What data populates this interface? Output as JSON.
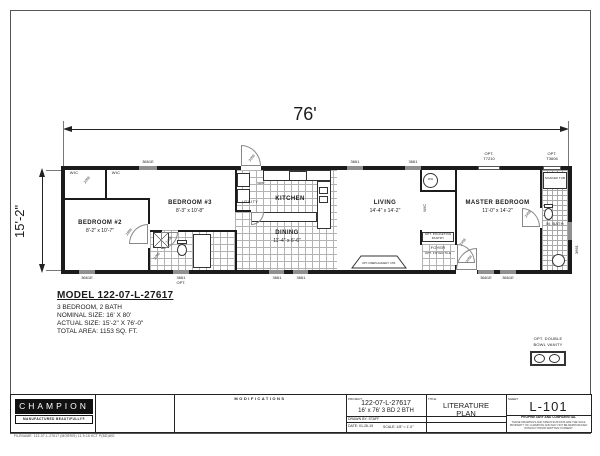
{
  "plan": {
    "dim_width": "76'",
    "dim_height": "15'-2\"",
    "bedroom2": {
      "name": "BEDROOM #2",
      "size": "8'-2\" x 10'-7\""
    },
    "bedroom3": {
      "name": "BEDROOM #3",
      "size": "8'-3\" x 10'-8\""
    },
    "kitchen": {
      "name": "KITCHEN"
    },
    "dining": {
      "name": "DINING",
      "size": "11'-4\" x 6'-6\""
    },
    "living": {
      "name": "LIVING",
      "size": "14'-4\" x 14'-2\""
    },
    "master": {
      "name": "MASTER BEDROOM",
      "size": "11'-0\" x 14'-2\""
    },
    "mbath": "M. BATH",
    "utility": "UTILITY",
    "foyer": "FOYER",
    "labels": {
      "wic": "WIC",
      "wh": "WH",
      "wdp": "WDP",
      "opt_foyer_tile": "OPT. FOYER TILE",
      "pantry_1": "OPT. POCKETING",
      "pantry_2": "PANTRY",
      "soaker_tub": "SOAKER TUB",
      "fireplace": "OPT. FIREPLACE/ENT. CTR.",
      "vanity_1": "OPT. DOUBLE",
      "vanity_2": "BOWL VANITY"
    },
    "windows": {
      "t1": "3661E",
      "t2": "3661",
      "t3": "3661",
      "t4a": "OPT.",
      "t4b": "T7210",
      "t5a": "OPT.",
      "t5b": "T3606",
      "b1": "3661E",
      "b2a": "3661",
      "b2b": "OPT.",
      "b3": "3661",
      "b4": "3661",
      "b5": "3661E",
      "b6": "3661E",
      "r1": "3661"
    },
    "doors": {
      "d1": "2068",
      "d2": "2868",
      "d3": "2468",
      "d4": "2068",
      "d5": "3068",
      "d6": "2468",
      "d7": "3068",
      "d8": "2468"
    }
  },
  "model_block": {
    "title": "MODEL 122-07-L-27617",
    "line1": "3 BEDROOM, 2 BATH",
    "line2": "NOMINAL SIZE: 16' X 80'",
    "line3": "ACTUAL SIZE: 15'-2\" X 76'-0\"",
    "line4": "TOTAL AREA: 1153 SQ. FT."
  },
  "title_block": {
    "brand": "CHAMPION",
    "tagline": "MANUFACTURED BEAUTIFULLY®",
    "modifications": "MODIFICATIONS",
    "project_label": "PROJECT:",
    "project_number": "122-07-L-27617",
    "project_desc": "16' x 76' 3 BD 2 BTH",
    "drawn_by": "DRAWN BY:  STAFF",
    "date": "DATE: 01-26-19",
    "scale": "SCALE: 1/8\" = 1'-0\"",
    "title_label": "TITLE:",
    "sheet_title1": "LITERATURE",
    "sheet_title2": "PLAN",
    "sheet_label": "SHEET:",
    "sheet_number": "L-101",
    "legal1": "PROPRIETARY AND CONFIDENTIAL",
    "legal2": "THESE DRAWINGS AND SPECIFICATIONS ARE THE SOLE",
    "legal3": "PROPERTY OF CHAMPION AND MAY NOT BE REPRODUCED",
    "legal4": "WITHOUT PRIOR WRITTEN CONSENT",
    "filename": "FILENAME: 122-07-L-27617 (MORRIS) 11-9-16 KCT P(BD)WG"
  }
}
